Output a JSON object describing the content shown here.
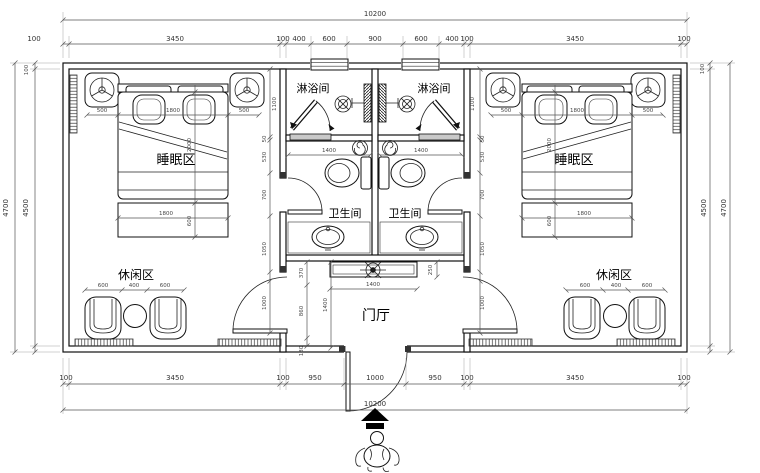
{
  "labels": {
    "shower": "淋浴间",
    "toilet": "卫生间",
    "sleep": "睡眠区",
    "leisure": "休闲区",
    "foyer": "门厅"
  },
  "dims": {
    "total": "10200",
    "top_chain": [
      "100",
      "3450",
      "100",
      "400",
      "600",
      "900",
      "600",
      "400",
      "100",
      "3450",
      "100"
    ],
    "bottom_chain": [
      "100",
      "3450",
      "100",
      "950",
      "1000",
      "950",
      "100",
      "3450",
      "100"
    ],
    "side": {
      "outer": "4700",
      "inner": "4500",
      "wall": "100"
    },
    "bed_width": [
      "500",
      "1800",
      "500"
    ],
    "bed_length": "2000",
    "bench": {
      "w": "1800",
      "d": "600"
    },
    "wall_chain": [
      "1100",
      "50",
      "530",
      "700",
      "1050"
    ],
    "bedroom_door": "1000",
    "leisure_chain": [
      "600",
      "400",
      "600"
    ],
    "shower_width": "1400",
    "cabinet_width": "1400",
    "foyer_depth": "1400",
    "foyer_chain": [
      "370",
      "860",
      "130"
    ],
    "cabinet_gap": "250"
  }
}
